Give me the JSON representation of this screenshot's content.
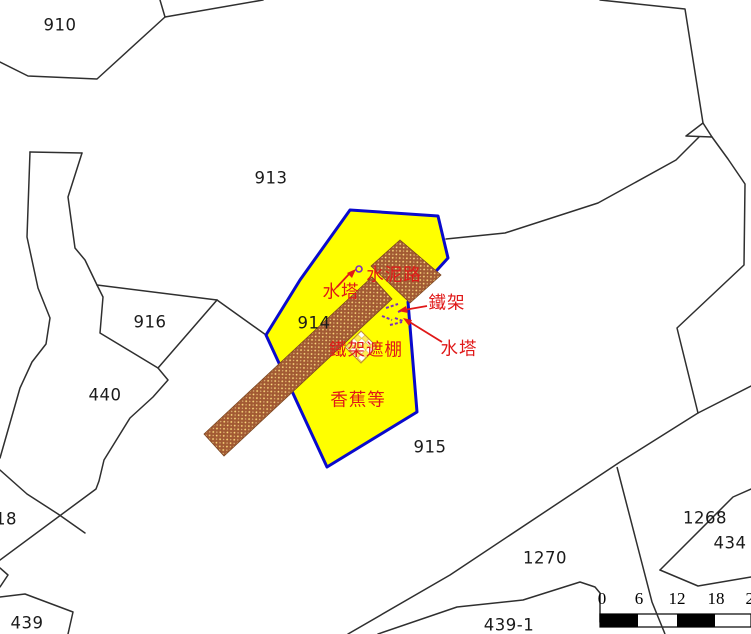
{
  "map": {
    "parcels": {
      "p910": "910",
      "p913": "913",
      "p916": "916",
      "p914": "914",
      "p440": "440",
      "p915": "915",
      "p1270": "1270",
      "p1268": "1268",
      "p434": "434",
      "p439_1": "439-1",
      "p439": "439",
      "p18": "18"
    },
    "annotations": {
      "cement_road": "水泥路",
      "water_tower_1": "水塔",
      "iron_frame": "鐵架",
      "water_tower_2": "水塔",
      "iron_frame_canopy": "鐵架遮棚",
      "bananas": "香蕉等"
    },
    "scale_bar": {
      "ticks": [
        "0",
        "6",
        "12",
        "18",
        "24"
      ]
    },
    "colors": {
      "highlight_fill": "#ffff00",
      "highlight_border": "#0a0acd",
      "road_brown": "#a25a33",
      "road_dots": "#ffdf80",
      "annotation_red": "#e01818",
      "symbol_purple": "#7b2fbe",
      "boundary_black": "#2f2f2f"
    }
  }
}
